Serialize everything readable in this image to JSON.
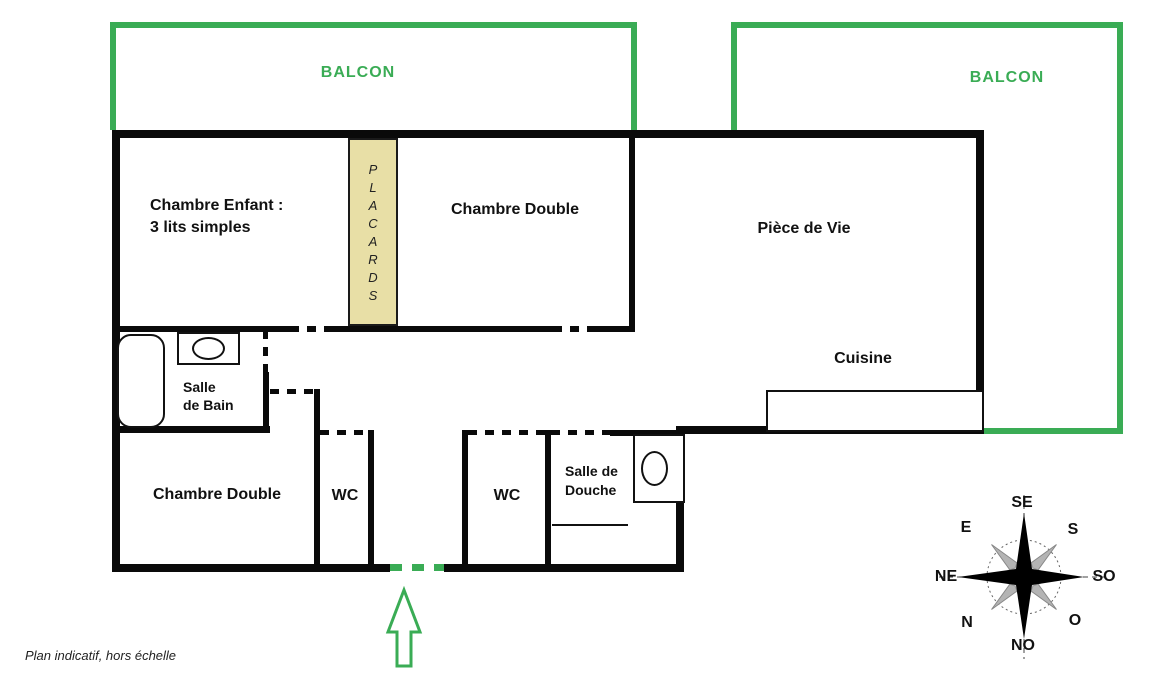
{
  "footnote": "Plan indicatif, hors échelle",
  "balconies": {
    "left": "BALCON",
    "right": "BALCON"
  },
  "rooms": {
    "chambre_enfant_line1": "Chambre Enfant :",
    "chambre_enfant_line2": "3 lits simples",
    "chambre_double_top": "Chambre Double",
    "piece_de_vie": "Pièce de Vie",
    "cuisine": "Cuisine",
    "salle_de_bain_line1": "Salle",
    "salle_de_bain_line2": "de Bain",
    "chambre_double_bottom": "Chambre Double",
    "wc_left": "WC",
    "wc_right": "WC",
    "salle_de_douche_line1": "Salle de",
    "salle_de_douche_line2": "Douche",
    "placards_letters": [
      "P",
      "L",
      "A",
      "C",
      "A",
      "R",
      "D",
      "S"
    ]
  },
  "compass": {
    "se": "SE",
    "s": "S",
    "so": "SO",
    "o": "O",
    "no": "NO",
    "n": "N",
    "ne": "NE",
    "e": "E"
  },
  "colors": {
    "balcony_green": "#3aac55",
    "wall_black": "#0a0a0a",
    "placard_fill": "#e8dfa6"
  }
}
